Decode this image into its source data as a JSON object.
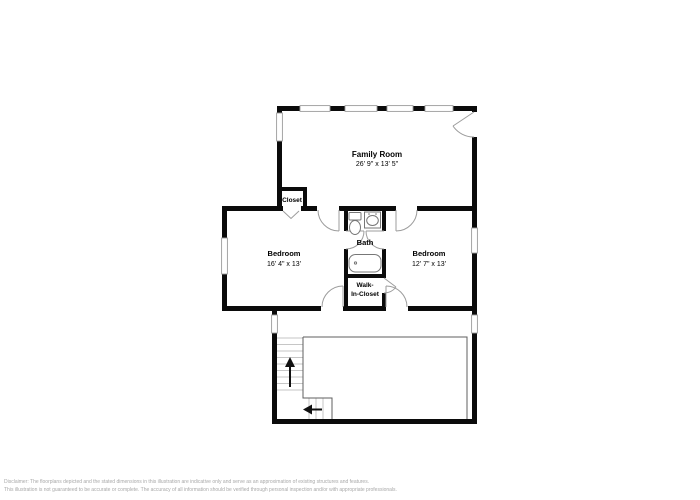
{
  "rooms": {
    "family_room": {
      "name": "Family Room",
      "dims": "26' 9\" x 13' 5\""
    },
    "closet": {
      "name": "Closet"
    },
    "bedroom_left": {
      "name": "Bedroom",
      "dims": "16' 4\" x 13'"
    },
    "bath": {
      "name": "Bath"
    },
    "walk_in_closet": {
      "line1": "Walk-",
      "line2": "In-Closet"
    },
    "bedroom_right": {
      "name": "Bedroom",
      "dims": "12' 7\" x 13'"
    }
  },
  "icons": {
    "stair_up_arrow": "↑",
    "stair_down_arrow": "←"
  },
  "colors": {
    "background": "#ffffff",
    "wall": "#0b0b0b",
    "window_frame": "#9c9c9c",
    "door": "#9c9c9c",
    "fixture": "#777777",
    "stair_tread": "#c6c6c6",
    "stair_void_outline": "#5f5f5f",
    "label_text": "#000000",
    "disclaimer_text": "#a8a8a8"
  },
  "disclaimer": {
    "line1": "Disclaimer: The floorplans depicted and the stated dimensions in this illustration are indicative only and serve as an approximation of existing structures and features.",
    "line2": "This illustration is not guaranteed to be accurate or complete. The accuracy of all information should be verified through personal inspection and/or with appropriate professionals."
  }
}
